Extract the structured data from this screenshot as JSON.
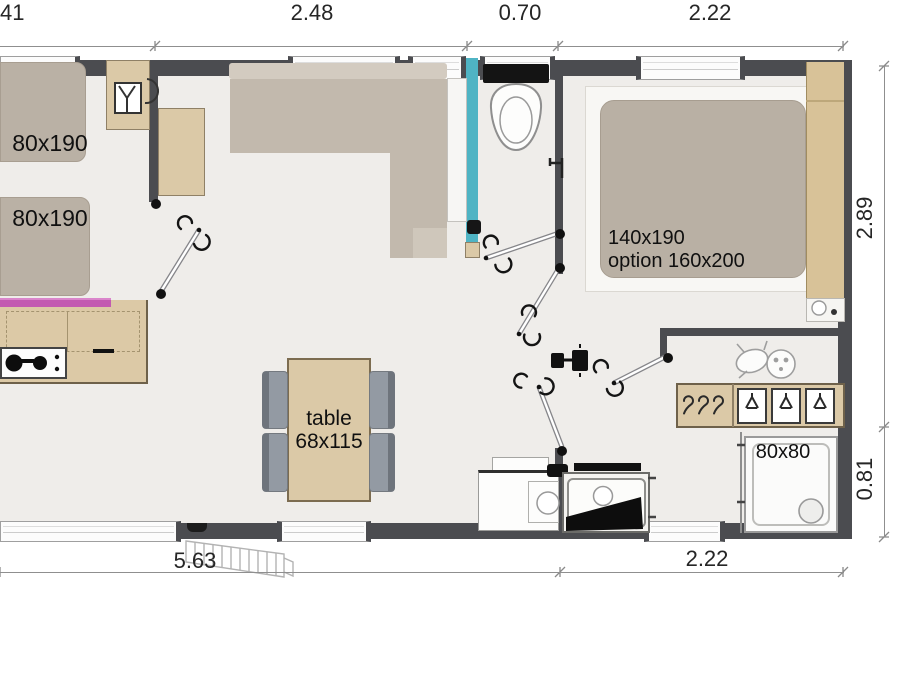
{
  "plan": {
    "dims_top": {
      "d0": "41",
      "d1": "2.48",
      "d2": "0.70",
      "d3": "2.22"
    },
    "dims_bottom": {
      "d1": "5.63",
      "d2": "2.22"
    },
    "dims_right": {
      "d1": "2.89",
      "d2": "0.81"
    },
    "rooms": {
      "bed_single_1": "80x190",
      "bed_single_2": "80x190",
      "bed_double_line1": "140x190",
      "bed_double_line2": "option 160x200",
      "table_line1": "table",
      "table_line2": "68x115",
      "shower": "80x80"
    },
    "icons": {
      "wardrobe_small": "shirt-hanger-icon",
      "closet_left": "hanger-hook-icons",
      "closet_shelves": "folded-clothes-hanger-icons",
      "closet_top": "baby-sketch-icon",
      "bathroom": "toilet-icon",
      "kitchen": "stove-burners-icon",
      "shower": "drain-icon",
      "doors": "door-swing-arc-icons",
      "outside": "entry-steps-icon"
    },
    "colors": {
      "wall": "#4b4c50",
      "floor": "#efedea",
      "wood": "#dbc9a7",
      "wood_dark": "#d8c298",
      "upholstery": "#bcb3a7",
      "accent_cyan": "#4fb4c4",
      "accent_magenta": "#c35ab1",
      "chair_gray": "#939aa3"
    }
  }
}
